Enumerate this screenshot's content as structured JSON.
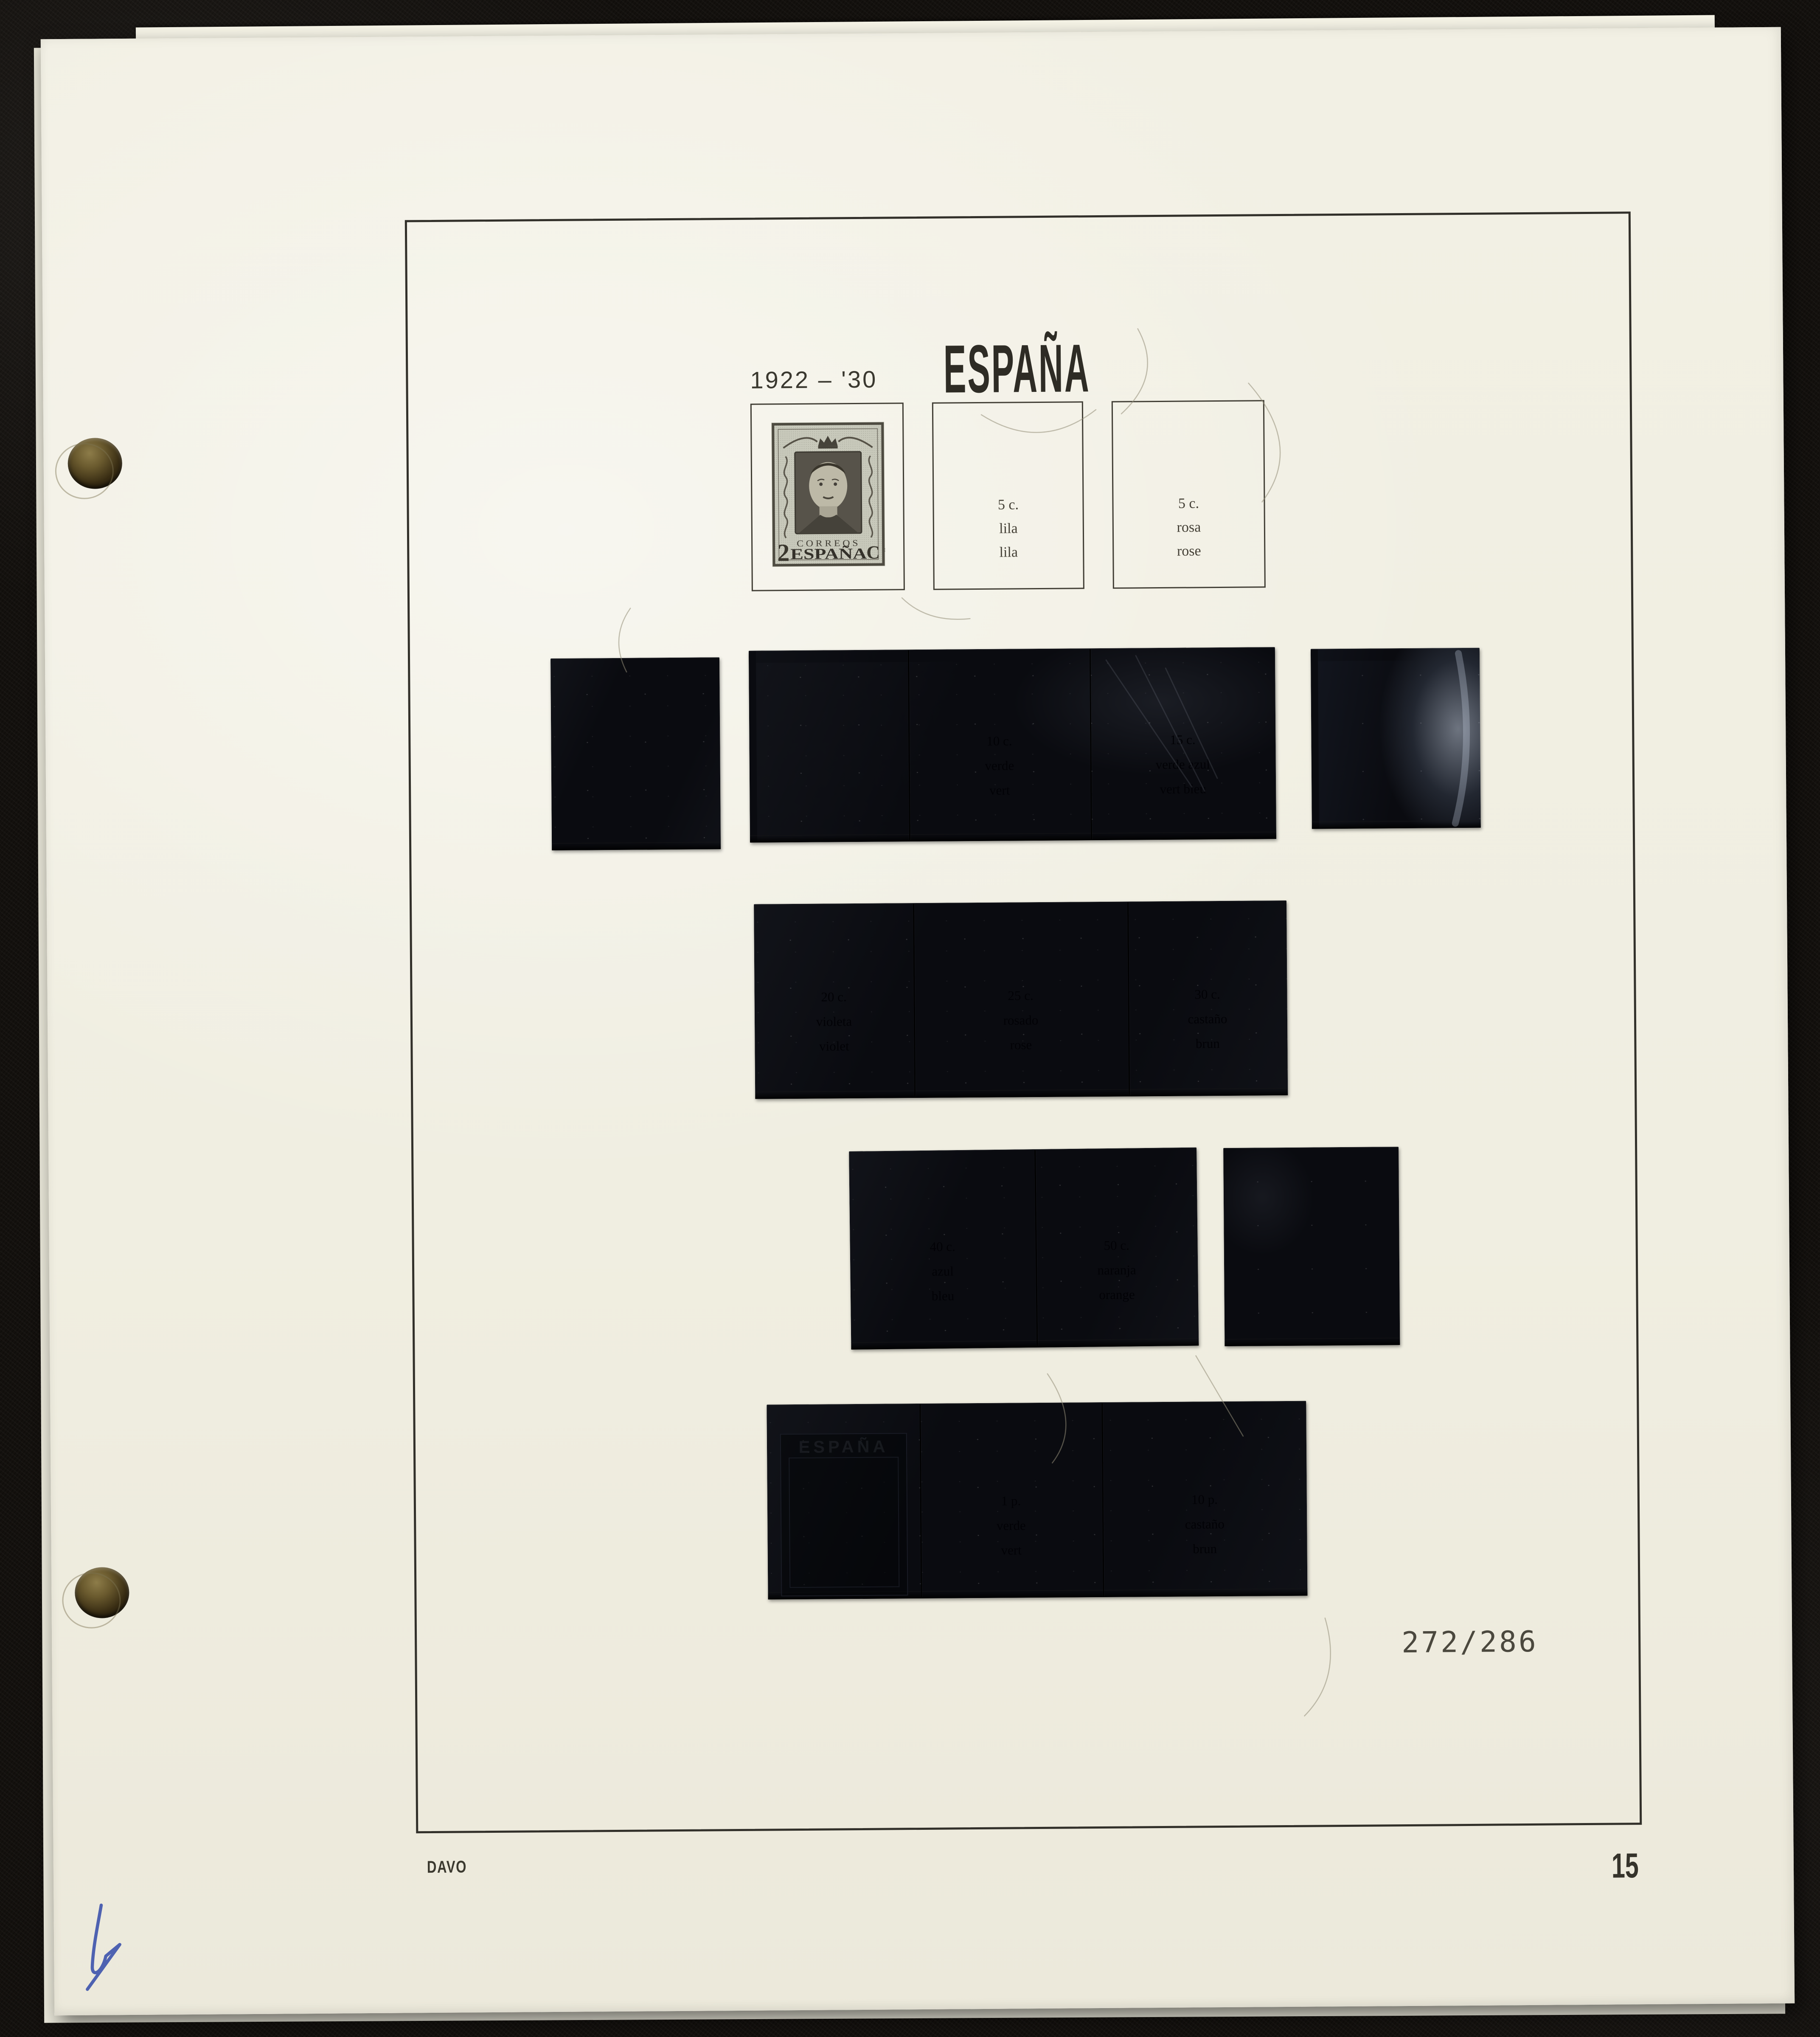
{
  "album_page": {
    "country_title": "ESPAÑA",
    "period": "1922 – '30",
    "catalog_range": "272/286",
    "publisher": "DAVO",
    "page_number": "15"
  },
  "stamp": {
    "top_text": "CORREOS",
    "country_text": "ESPAÑA",
    "value_left": "2",
    "value_right": "C",
    "value_right_sup": "s"
  },
  "value_boxes": [
    {
      "lines": [
        "5 c.",
        "lila",
        "lila"
      ]
    },
    {
      "lines": [
        "5 c.",
        "rosa",
        "rose"
      ]
    }
  ],
  "mounts": {
    "ghost_stamp_text": "ESPAÑA",
    "faint_labels": {
      "r1s2": [
        "10 c.",
        "verde",
        "vert"
      ],
      "r1s3": [
        "15 c.",
        "verde azul",
        "vert bleu"
      ],
      "r2s1": [
        "20 c.",
        "violeta",
        "violet"
      ],
      "r2s2": [
        "25 c.",
        "rosado",
        "rose"
      ],
      "r2s3": [
        "30 c.",
        "castaño",
        "brun"
      ],
      "r3s1": [
        "40 c.",
        "azul",
        "bleu"
      ],
      "r3s2": [
        "50 c.",
        "naranja",
        "orange"
      ],
      "r4s2": [
        "1 p.",
        "verde",
        "vert"
      ],
      "r4s3": [
        "10 p.",
        "castaño",
        "brun"
      ]
    }
  },
  "colors": {
    "paper": "#f1efe2",
    "backdrop": "#14110e",
    "frame_line": "#32302a",
    "ink": "#3a382f",
    "mount_black": "#0a0b10",
    "pen_ink_blue": "#3d53ac"
  }
}
